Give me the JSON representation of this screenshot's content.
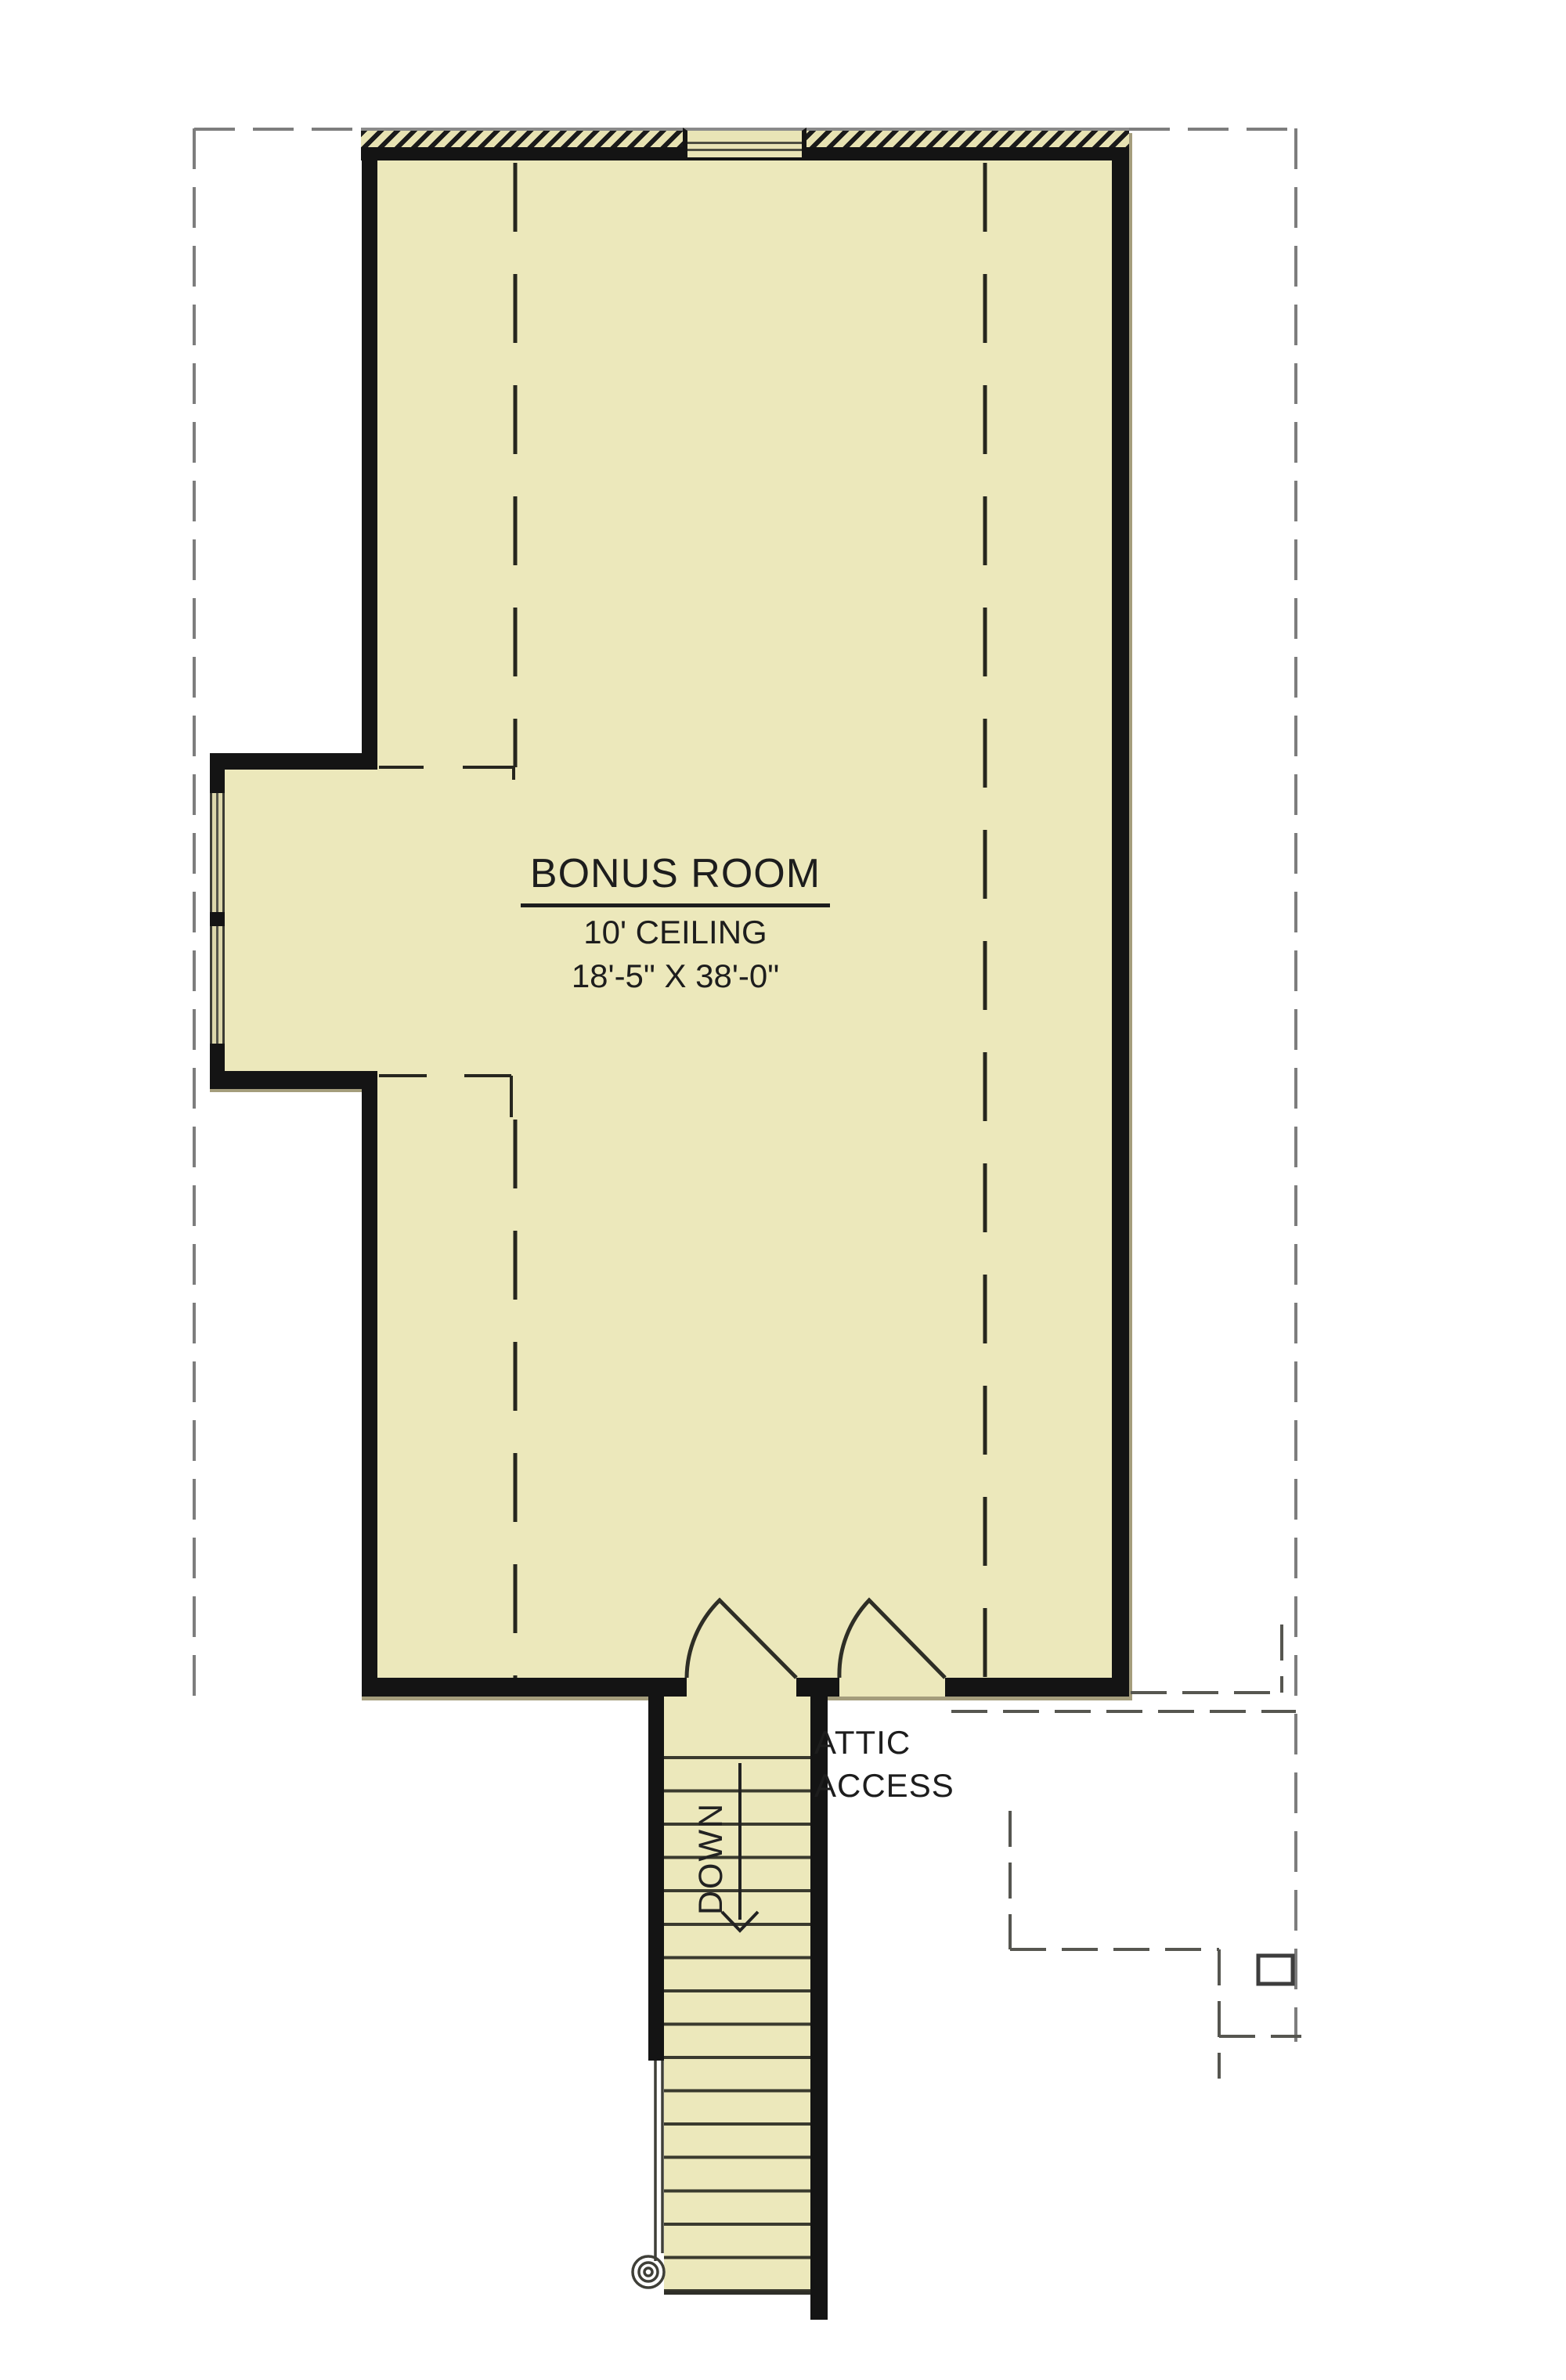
{
  "plan": {
    "room": {
      "title": "BONUS ROOM",
      "ceiling": "10' CEILING",
      "dimensions": "18'-5\" X 38'-0\""
    },
    "attic_access": {
      "line1": "ATTIC",
      "line2": "ACCESS"
    },
    "stairs": {
      "direction": "DOWN"
    }
  },
  "colors": {
    "background": "#ffffff",
    "floor_fill": "#ece8bb",
    "wall": "#141414",
    "roof_outline_gray": "#7d7d7d",
    "detail_gray": "#565650",
    "ceiling_break_line": "#26261e",
    "hatch_dark": "#1a1a1a",
    "hatch_light": "#e7e2b2",
    "window_glaze": "#dcd7ab",
    "wall_shadow": "#a49d7c",
    "tread": "#3a3a2e",
    "text": "#1d1d1d"
  }
}
